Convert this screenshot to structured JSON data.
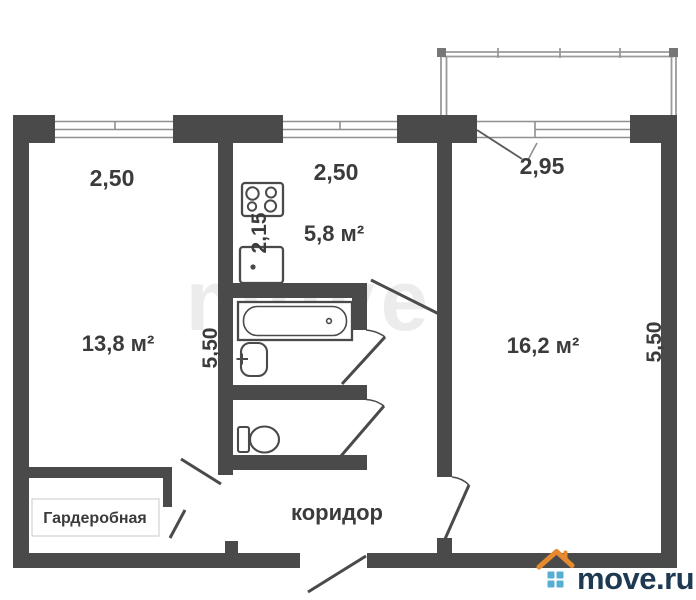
{
  "dimensions": {
    "left_room_width": "2,50",
    "kitchen_width": "2,50",
    "right_room_width": "2,95",
    "kitchen_depth": "2,15",
    "left_side_height": "5,50",
    "right_side_height": "5,50"
  },
  "areas": {
    "left_room": "13,8 м²",
    "kitchen": "5,8 м²",
    "right_room": "16,2 м²"
  },
  "rooms": {
    "corridor": "коридор",
    "wardrobe": "Гардеробная"
  },
  "watermark": "move",
  "logo": {
    "text": "move.ru",
    "roof_color": "#e78a2e",
    "squares_color": "#56aed1",
    "text_color": "#1e3a52"
  },
  "colors": {
    "background": "#ffffff",
    "wall": "#4a4a4a",
    "thin_line": "#8f8f8f",
    "label_text": "#3b3b3b"
  }
}
